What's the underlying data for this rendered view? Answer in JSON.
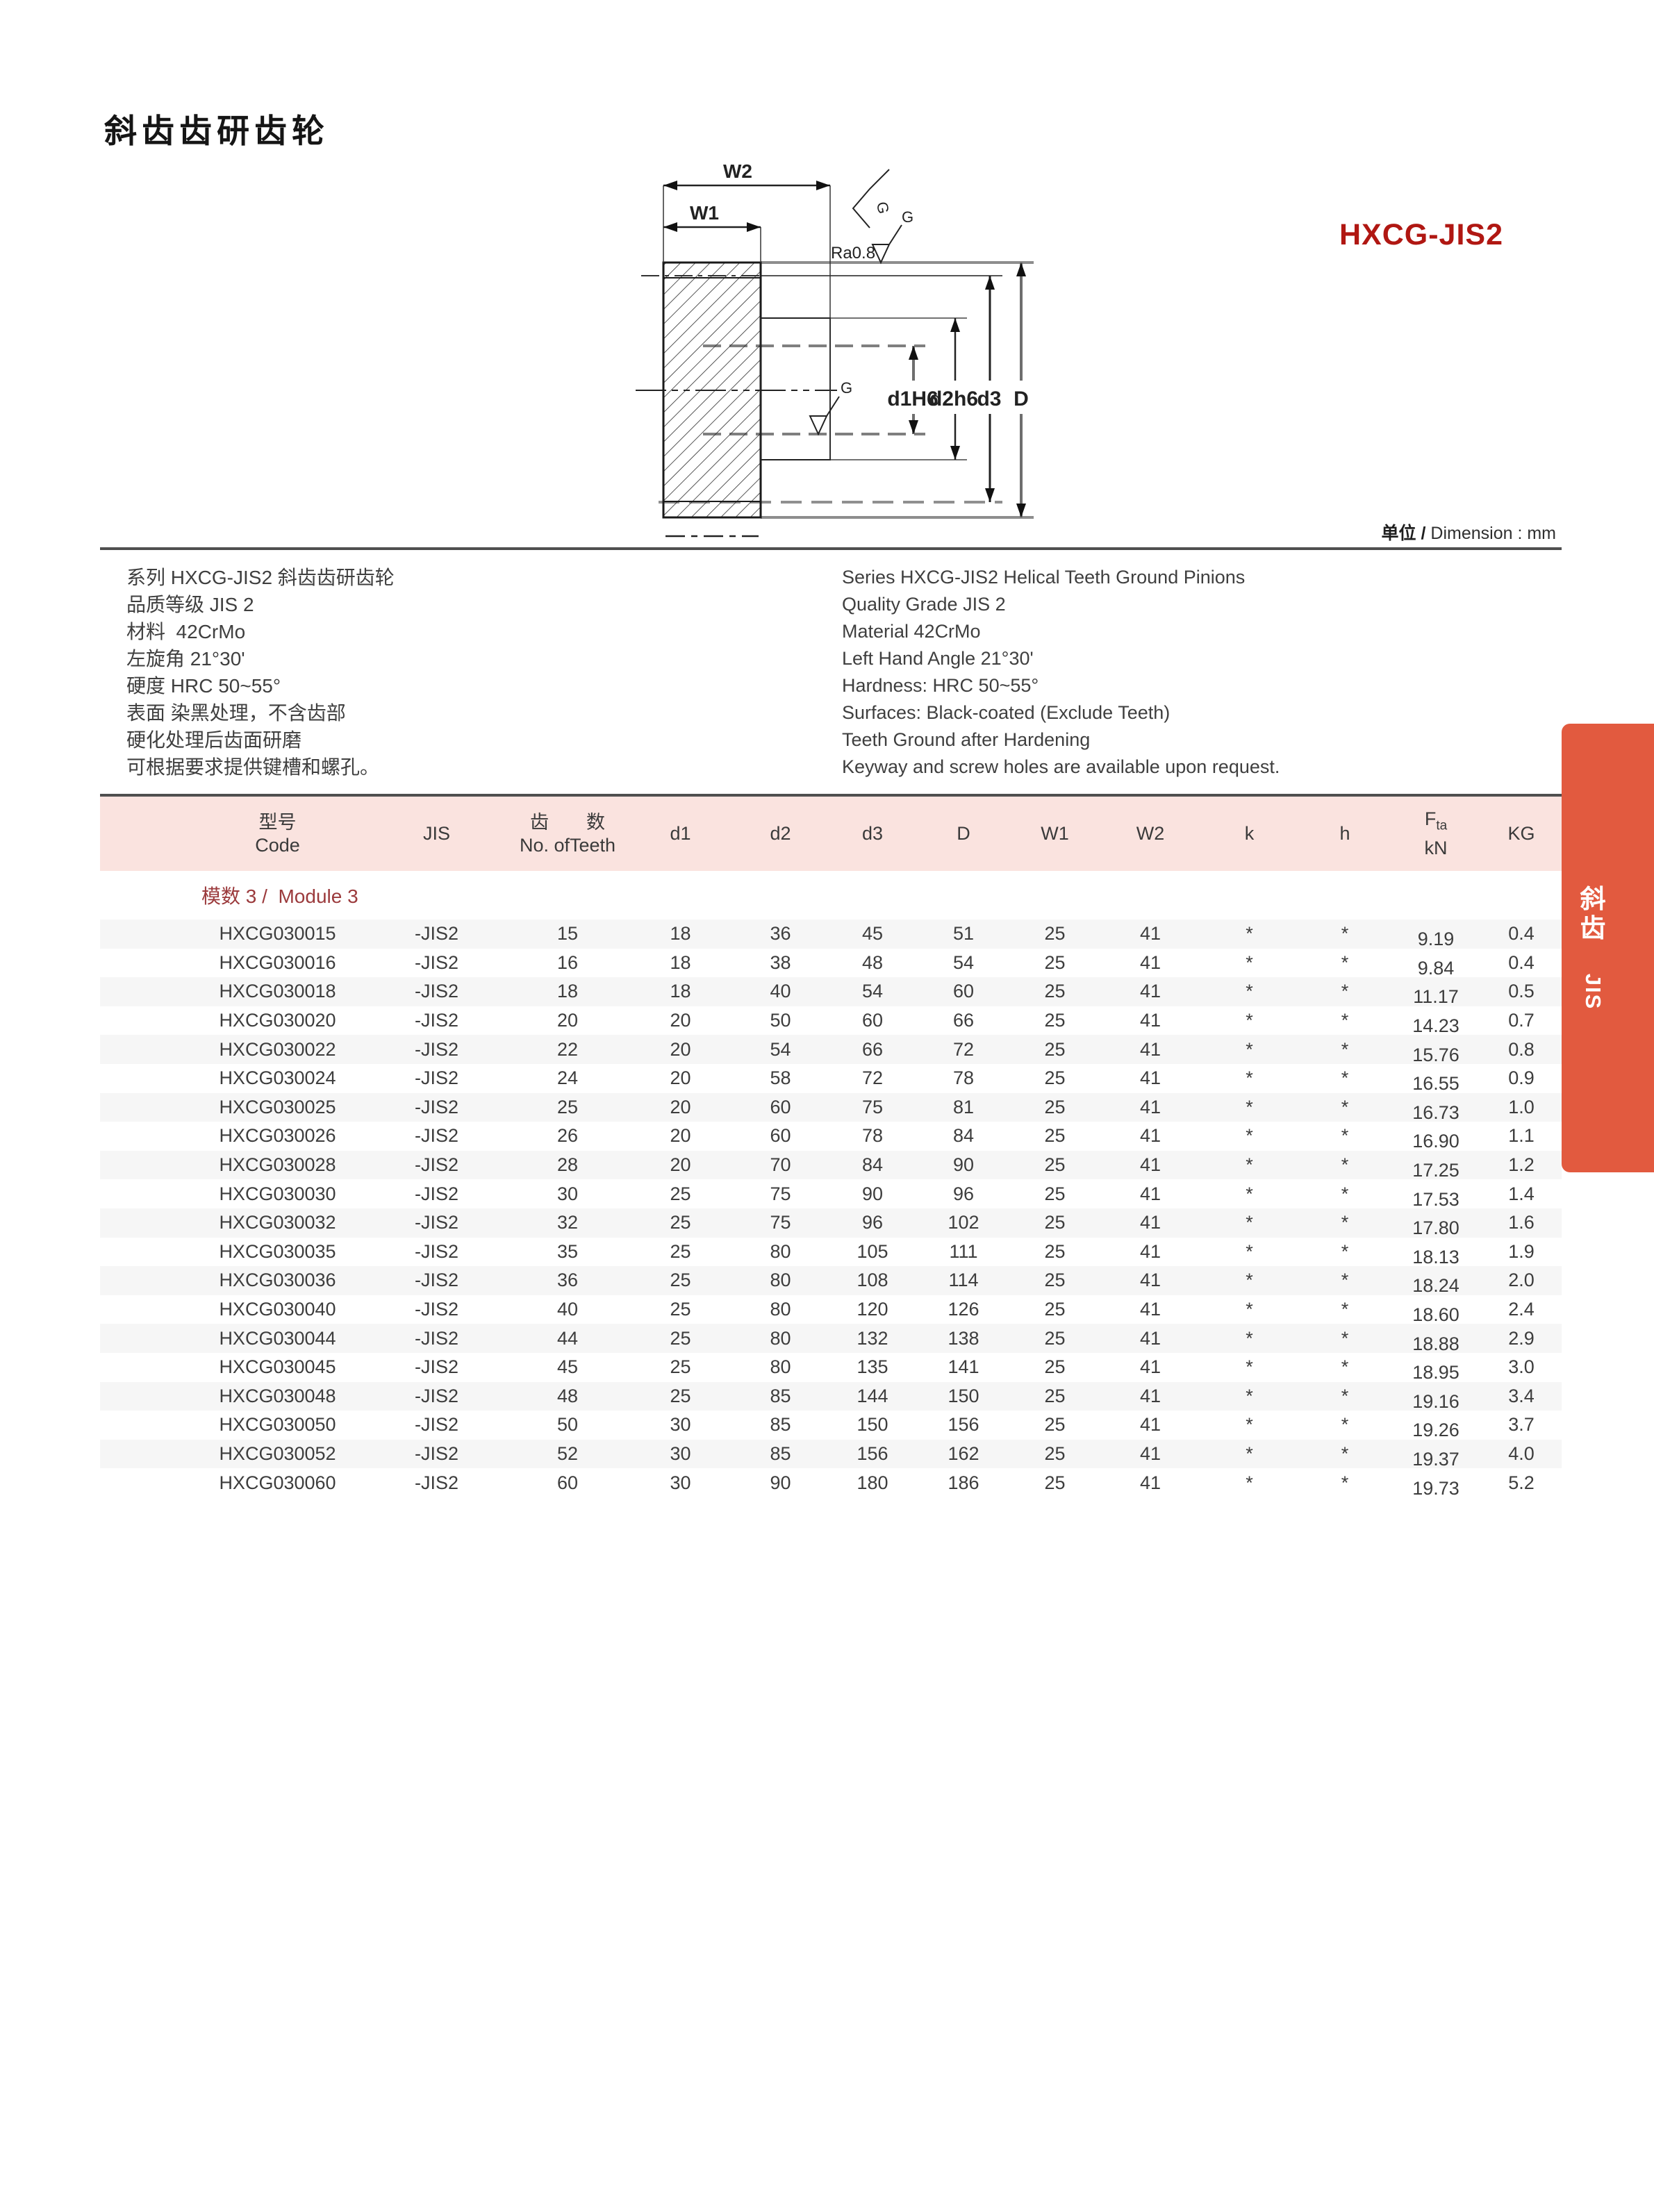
{
  "page_title": "斜齿齿研齿轮",
  "product_code": "HXCG-JIS2",
  "unit_note": {
    "zh": "单位 /",
    "en": " Dimension : mm"
  },
  "drawing": {
    "labels": {
      "w1": "W1",
      "w2": "W2",
      "ra": "Ra0.8",
      "g": "G",
      "d1": "d1H6",
      "d2": "d2h6",
      "d3": "d3",
      "D": "D"
    }
  },
  "specs": {
    "zh": [
      "系列 HXCG-JIS2 斜齿齿研齿轮",
      "品质等级 JIS 2",
      "材料  42CrMo",
      "左旋角 21°30'",
      "硬度 HRC 50~55°",
      "表面 染黑处理，不含齿部",
      "硬化处理后齿面研磨",
      "可根据要求提供键槽和螺孔。"
    ],
    "en": [
      "Series HXCG-JIS2 Helical Teeth Ground Pinions",
      "Quality Grade JIS 2",
      "Material 42CrMo",
      "Left Hand Angle 21°30'",
      "Hardness: HRC 50~55°",
      "Surfaces: Black-coated (Exclude Teeth)",
      "Teeth Ground after Hardening",
      "Keyway and screw holes are available upon request."
    ]
  },
  "table": {
    "headers": {
      "code_zh": "型号",
      "code_en": "Code",
      "jis": "JIS",
      "teeth_zh": "齿　　数",
      "teeth_en": "No. ofTeeth",
      "d1": "d1",
      "d2": "d2",
      "d3": "d3",
      "D": "D",
      "w1": "W1",
      "w2": "W2",
      "k": "k",
      "h": "h",
      "fta_f": "F",
      "fta_sub": "ta",
      "fta_unit": "kN",
      "kg": "KG"
    },
    "module_label": "模数 3 /  Module 3",
    "rows": [
      [
        "HXCG030015",
        "-JIS2",
        "15",
        "18",
        "36",
        "45",
        "51",
        "25",
        "41",
        "*",
        "*",
        "9.19",
        "0.4"
      ],
      [
        "HXCG030016",
        "-JIS2",
        "16",
        "18",
        "38",
        "48",
        "54",
        "25",
        "41",
        "*",
        "*",
        "9.84",
        "0.4"
      ],
      [
        "HXCG030018",
        "-JIS2",
        "18",
        "18",
        "40",
        "54",
        "60",
        "25",
        "41",
        "*",
        "*",
        "11.17",
        "0.5"
      ],
      [
        "HXCG030020",
        "-JIS2",
        "20",
        "20",
        "50",
        "60",
        "66",
        "25",
        "41",
        "*",
        "*",
        "14.23",
        "0.7"
      ],
      [
        "HXCG030022",
        "-JIS2",
        "22",
        "20",
        "54",
        "66",
        "72",
        "25",
        "41",
        "*",
        "*",
        "15.76",
        "0.8"
      ],
      [
        "HXCG030024",
        "-JIS2",
        "24",
        "20",
        "58",
        "72",
        "78",
        "25",
        "41",
        "*",
        "*",
        "16.55",
        "0.9"
      ],
      [
        "HXCG030025",
        "-JIS2",
        "25",
        "20",
        "60",
        "75",
        "81",
        "25",
        "41",
        "*",
        "*",
        "16.73",
        "1.0"
      ],
      [
        "HXCG030026",
        "-JIS2",
        "26",
        "20",
        "60",
        "78",
        "84",
        "25",
        "41",
        "*",
        "*",
        "16.90",
        "1.1"
      ],
      [
        "HXCG030028",
        "-JIS2",
        "28",
        "20",
        "70",
        "84",
        "90",
        "25",
        "41",
        "*",
        "*",
        "17.25",
        "1.2"
      ],
      [
        "HXCG030030",
        "-JIS2",
        "30",
        "25",
        "75",
        "90",
        "96",
        "25",
        "41",
        "*",
        "*",
        "17.53",
        "1.4"
      ],
      [
        "HXCG030032",
        "-JIS2",
        "32",
        "25",
        "75",
        "96",
        "102",
        "25",
        "41",
        "*",
        "*",
        "17.80",
        "1.6"
      ],
      [
        "HXCG030035",
        "-JIS2",
        "35",
        "25",
        "80",
        "105",
        "111",
        "25",
        "41",
        "*",
        "*",
        "18.13",
        "1.9"
      ],
      [
        "HXCG030036",
        "-JIS2",
        "36",
        "25",
        "80",
        "108",
        "114",
        "25",
        "41",
        "*",
        "*",
        "18.24",
        "2.0"
      ],
      [
        "HXCG030040",
        "-JIS2",
        "40",
        "25",
        "80",
        "120",
        "126",
        "25",
        "41",
        "*",
        "*",
        "18.60",
        "2.4"
      ],
      [
        "HXCG030044",
        "-JIS2",
        "44",
        "25",
        "80",
        "132",
        "138",
        "25",
        "41",
        "*",
        "*",
        "18.88",
        "2.9"
      ],
      [
        "HXCG030045",
        "-JIS2",
        "45",
        "25",
        "80",
        "135",
        "141",
        "25",
        "41",
        "*",
        "*",
        "18.95",
        "3.0"
      ],
      [
        "HXCG030048",
        "-JIS2",
        "48",
        "25",
        "85",
        "144",
        "150",
        "25",
        "41",
        "*",
        "*",
        "19.16",
        "3.4"
      ],
      [
        "HXCG030050",
        "-JIS2",
        "50",
        "30",
        "85",
        "150",
        "156",
        "25",
        "41",
        "*",
        "*",
        "19.26",
        "3.7"
      ],
      [
        "HXCG030052",
        "-JIS2",
        "52",
        "30",
        "85",
        "156",
        "162",
        "25",
        "41",
        "*",
        "*",
        "19.37",
        "4.0"
      ],
      [
        "HXCG030060",
        "-JIS2",
        "60",
        "30",
        "90",
        "180",
        "186",
        "25",
        "41",
        "*",
        "*",
        "19.73",
        "5.2"
      ]
    ]
  },
  "side_tab": {
    "zh1": "斜",
    "zh2": "齿",
    "jis": "JIS"
  },
  "colors": {
    "accent_red": "#b01712",
    "module_red": "#9b3a3c",
    "header_pink": "#fae3df",
    "row_gray": "#f6f6f6",
    "tab_orange": "#e25a3f"
  }
}
